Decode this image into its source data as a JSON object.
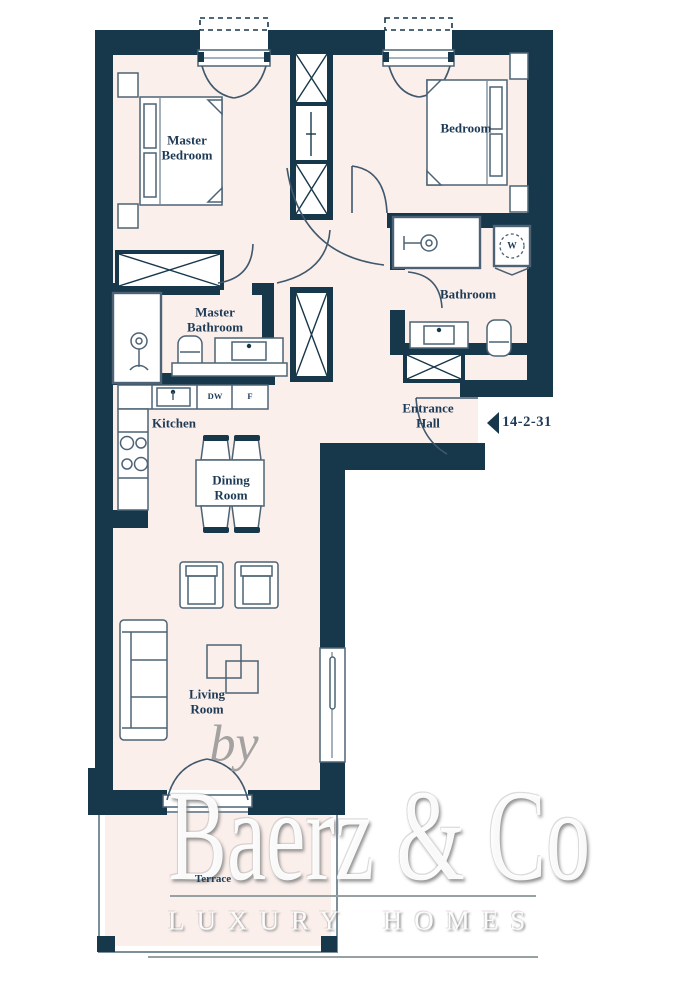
{
  "colors": {
    "wall": "#17374b",
    "floor": "#fbefeb",
    "outline": "#4d6375",
    "arc": "#3f586c",
    "label": "#1d3a56",
    "terrace": "#7d8f9b",
    "bygray": "#9a9a9a",
    "linegray": "#97a1a1",
    "watermark_gray": "#8f8f8f"
  },
  "rooms": {
    "master_bedroom": {
      "label": "Master Bedroom",
      "lines": [
        "Master",
        "Bedroom"
      ]
    },
    "bedroom": {
      "label": "Bedroom"
    },
    "bathroom": {
      "label": "Bathroom"
    },
    "master_bathroom": {
      "label": "Master Bathroom",
      "lines": [
        "Master",
        "Bathroom"
      ]
    },
    "kitchen": {
      "label": "Kitchen"
    },
    "entrance_hall": {
      "label": "Entrance Hall",
      "lines": [
        "Entrance",
        "Hall"
      ]
    },
    "dining_room": {
      "label": "Dining Room",
      "lines": [
        "Dining",
        "Room"
      ]
    },
    "living_room": {
      "label": "Living Room",
      "lines": [
        "Living",
        "Room"
      ]
    },
    "terrace": {
      "label": "Terrace"
    }
  },
  "appliances": {
    "dishwasher_label": "DW",
    "fridge_label": "F",
    "washer_label": "W"
  },
  "entrance_marker": {
    "unit_number": "14-2-31"
  },
  "watermark": {
    "prefix": "by",
    "brand": "Baerz & Co",
    "tagline": "LUXURY HOMES"
  }
}
